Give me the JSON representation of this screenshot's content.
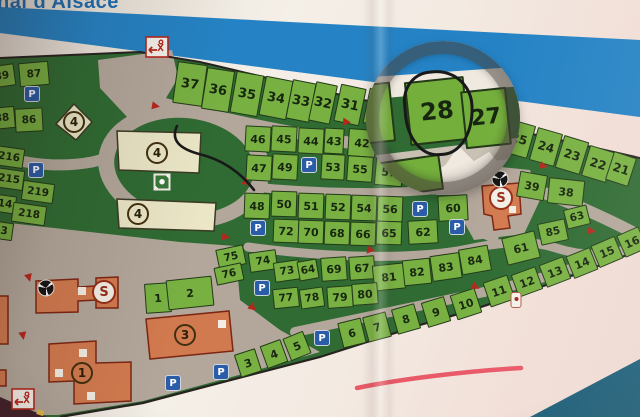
{
  "photo_title_partial": "nal d'Alsace",
  "legend": {
    "parking": "P",
    "sanitary": "S"
  },
  "highlight": {
    "circled_plot": "28",
    "underlined_area": "shore-strip"
  },
  "colors": {
    "stripe_blue": "#2583c5",
    "plot_green": "#78b142",
    "map_green": "#2f6b33",
    "road_grey": "#b3a79b",
    "building_orange": "#d27a4f",
    "building_beige": "#eae6c6",
    "water_blue": "#1a5d78",
    "pen_black": "#191919",
    "underline_red": "#e8495a",
    "parking_blue": "#2a5ca8",
    "arrow_red": "#b5271d"
  },
  "icons": {
    "parking-icon": "P in blue rounded square",
    "sanitary-icon": "S in red-ringed circle",
    "shower-icon": "black circle with white fan blades",
    "playground-icon": "white-framed green square",
    "gate-icon": "red framed sign with left arrow",
    "marker-icon": "white tag with red dot",
    "direction-arrow-icon": "small red triangle"
  },
  "map": {
    "plots": [
      [
        "37",
        190,
        84,
        30,
        42,
        8,
        13
      ],
      [
        "36",
        218,
        90,
        28,
        42,
        9,
        13
      ],
      [
        "35",
        247,
        94,
        28,
        42,
        10,
        13
      ],
      [
        "34",
        276,
        98,
        28,
        40,
        11,
        13
      ],
      [
        "33",
        301,
        101,
        24,
        40,
        11,
        13
      ],
      [
        "32",
        323,
        103,
        22,
        40,
        12,
        13
      ],
      [
        "31",
        350,
        105,
        26,
        38,
        12,
        13
      ],
      [
        "3",
        374,
        107,
        16,
        36,
        12,
        12
      ],
      [
        "25",
        519,
        139,
        26,
        34,
        16,
        12
      ],
      [
        "24",
        546,
        147,
        26,
        34,
        16,
        12
      ],
      [
        "23",
        572,
        155,
        26,
        34,
        17,
        12
      ],
      [
        "22",
        598,
        164,
        26,
        32,
        17,
        12
      ],
      [
        "21",
        621,
        169,
        24,
        30,
        18,
        12
      ],
      [
        "46",
        258,
        139,
        26,
        26,
        3,
        11
      ],
      [
        "45",
        284,
        139,
        26,
        26,
        3,
        11
      ],
      [
        "44",
        311,
        141,
        26,
        26,
        3,
        11
      ],
      [
        "43",
        334,
        141,
        20,
        26,
        3,
        11
      ],
      [
        "42",
        362,
        143,
        28,
        28,
        4,
        11
      ],
      [
        "47",
        259,
        168,
        26,
        26,
        3,
        11
      ],
      [
        "49",
        285,
        167,
        26,
        26,
        3,
        11
      ],
      [
        "53",
        333,
        167,
        24,
        26,
        3,
        11
      ],
      [
        "55",
        360,
        169,
        26,
        26,
        4,
        11
      ],
      [
        "57",
        389,
        172,
        28,
        28,
        5,
        11
      ],
      [
        "48",
        257,
        206,
        26,
        26,
        2,
        11
      ],
      [
        "50",
        284,
        204,
        26,
        26,
        2,
        11
      ],
      [
        "51",
        311,
        206,
        26,
        26,
        2,
        11
      ],
      [
        "52",
        338,
        207,
        26,
        26,
        2,
        11
      ],
      [
        "54",
        364,
        208,
        26,
        26,
        2,
        11
      ],
      [
        "56",
        390,
        209,
        26,
        26,
        2,
        11
      ],
      [
        "60",
        453,
        208,
        30,
        26,
        -3,
        11
      ],
      [
        "72",
        286,
        231,
        26,
        24,
        2,
        11
      ],
      [
        "70",
        311,
        232,
        26,
        24,
        2,
        11
      ],
      [
        "68",
        337,
        233,
        26,
        24,
        2,
        11
      ],
      [
        "66",
        363,
        234,
        26,
        24,
        2,
        11
      ],
      [
        "65",
        389,
        233,
        26,
        24,
        2,
        11
      ],
      [
        "62",
        423,
        232,
        30,
        24,
        -3,
        11
      ],
      [
        "75",
        231,
        257,
        28,
        20,
        -12,
        10.5
      ],
      [
        "74",
        263,
        261,
        28,
        20,
        -8,
        10.5
      ],
      [
        "76",
        229,
        274,
        28,
        18,
        -12,
        10.5
      ],
      [
        "73",
        287,
        271,
        26,
        20,
        -8,
        10.5
      ],
      [
        "64",
        308,
        270,
        20,
        20,
        -10,
        10.5
      ],
      [
        "77",
        286,
        298,
        26,
        20,
        -6,
        10.5
      ],
      [
        "78",
        312,
        298,
        24,
        20,
        -8,
        10.5
      ],
      [
        "69",
        334,
        269,
        26,
        24,
        -4,
        11
      ],
      [
        "67",
        362,
        268,
        26,
        24,
        -4,
        11
      ],
      [
        "81",
        389,
        277,
        32,
        26,
        -6,
        11
      ],
      [
        "82",
        417,
        272,
        28,
        26,
        -6,
        11
      ],
      [
        "83",
        446,
        267,
        30,
        26,
        -8,
        11
      ],
      [
        "84",
        475,
        260,
        30,
        26,
        -10,
        11
      ],
      [
        "79",
        340,
        297,
        26,
        22,
        -4,
        11
      ],
      [
        "80",
        365,
        294,
        26,
        22,
        -4,
        11
      ],
      [
        "39",
        532,
        186,
        28,
        26,
        10,
        11
      ],
      [
        "38",
        566,
        192,
        36,
        26,
        6,
        11
      ],
      [
        "63",
        577,
        217,
        24,
        20,
        -14,
        10.5
      ],
      [
        "85",
        553,
        232,
        28,
        22,
        -12,
        10.5
      ],
      [
        "61",
        521,
        248,
        34,
        28,
        -14,
        11
      ],
      [
        "6",
        352,
        333,
        24,
        26,
        -14,
        11
      ],
      [
        "7",
        377,
        327,
        24,
        26,
        -15,
        11
      ],
      [
        "8",
        406,
        319,
        24,
        26,
        -16,
        11
      ],
      [
        "9",
        436,
        312,
        24,
        26,
        -17,
        11
      ],
      [
        "10",
        466,
        304,
        26,
        26,
        -18,
        11
      ],
      [
        "11",
        499,
        291,
        26,
        26,
        -19,
        11
      ],
      [
        "12",
        527,
        282,
        26,
        24,
        -20,
        11
      ],
      [
        "13",
        555,
        272,
        26,
        24,
        -21,
        11
      ],
      [
        "14",
        582,
        263,
        26,
        24,
        -22,
        11
      ],
      [
        "15",
        607,
        252,
        26,
        24,
        -23,
        11
      ],
      [
        "16",
        632,
        242,
        24,
        24,
        -24,
        11
      ],
      [
        "3",
        248,
        363,
        22,
        24,
        -18,
        11
      ],
      [
        "4",
        274,
        354,
        22,
        24,
        -20,
        11
      ],
      [
        "5",
        297,
        346,
        22,
        24,
        -22,
        11
      ],
      [
        "1",
        158,
        298,
        26,
        30,
        -4,
        11
      ],
      [
        "2",
        190,
        293,
        46,
        30,
        -6,
        11
      ],
      [
        "89",
        2,
        76,
        26,
        22,
        -8,
        10.5
      ],
      [
        "87",
        34,
        74,
        30,
        24,
        -5,
        10.5
      ],
      [
        "88",
        2,
        118,
        26,
        22,
        -5,
        10.5
      ],
      [
        "86",
        29,
        120,
        28,
        24,
        -3,
        10.5
      ],
      [
        "216",
        9,
        157,
        30,
        20,
        8,
        10.5
      ],
      [
        "215",
        9,
        179,
        30,
        20,
        8,
        10.5
      ],
      [
        "219",
        38,
        192,
        32,
        20,
        8,
        10.5
      ],
      [
        "14",
        5,
        204,
        22,
        18,
        8,
        10.5
      ],
      [
        "218",
        29,
        214,
        34,
        20,
        8,
        10.5
      ],
      [
        "3",
        4,
        231,
        18,
        18,
        8,
        10.5
      ]
    ],
    "magnifier": {
      "plots": [
        [
          "28",
          71,
          70,
          60,
          64,
          -6,
          24
        ],
        [
          "27",
          120,
          77,
          46,
          58,
          -6,
          22
        ],
        [
          "",
          12,
          72,
          30,
          60,
          -6,
          11
        ],
        [
          "",
          38,
          136,
          76,
          36,
          -8,
          11
        ]
      ]
    },
    "parkings": [
      [
        32,
        94
      ],
      [
        36,
        170
      ],
      [
        309,
        165
      ],
      [
        420,
        209
      ],
      [
        258,
        228
      ],
      [
        457,
        227
      ],
      [
        262,
        288
      ],
      [
        322,
        338
      ],
      [
        221,
        372
      ],
      [
        173,
        383
      ]
    ],
    "badges": [
      {
        "t": "4",
        "x": 74,
        "y": 122
      },
      {
        "t": "4",
        "x": 157,
        "y": 153
      },
      {
        "t": "4",
        "x": 138,
        "y": 214
      },
      {
        "t": "3",
        "x": 185,
        "y": 335
      },
      {
        "t": "1",
        "x": 82,
        "y": 373
      },
      {
        "t": "S",
        "x": 104,
        "y": 292,
        "s": 1
      },
      {
        "t": "S",
        "x": 501,
        "y": 198,
        "s": 1
      }
    ],
    "showers": [
      [
        46,
        288
      ],
      [
        500,
        179
      ]
    ],
    "arrows": [
      [
        156,
        106,
        100
      ],
      [
        347,
        122,
        95
      ],
      [
        247,
        183,
        125
      ],
      [
        226,
        237,
        100
      ],
      [
        371,
        250,
        95
      ],
      [
        476,
        287,
        115
      ],
      [
        544,
        166,
        105
      ],
      [
        592,
        231,
        100
      ],
      [
        29,
        278,
        165
      ],
      [
        23,
        336,
        170
      ],
      [
        253,
        308,
        130
      ]
    ],
    "playground": [
      162,
      182
    ],
    "marker": [
      516,
      300
    ],
    "gates": [
      [
        157,
        49
      ],
      [
        23,
        401
      ]
    ]
  }
}
